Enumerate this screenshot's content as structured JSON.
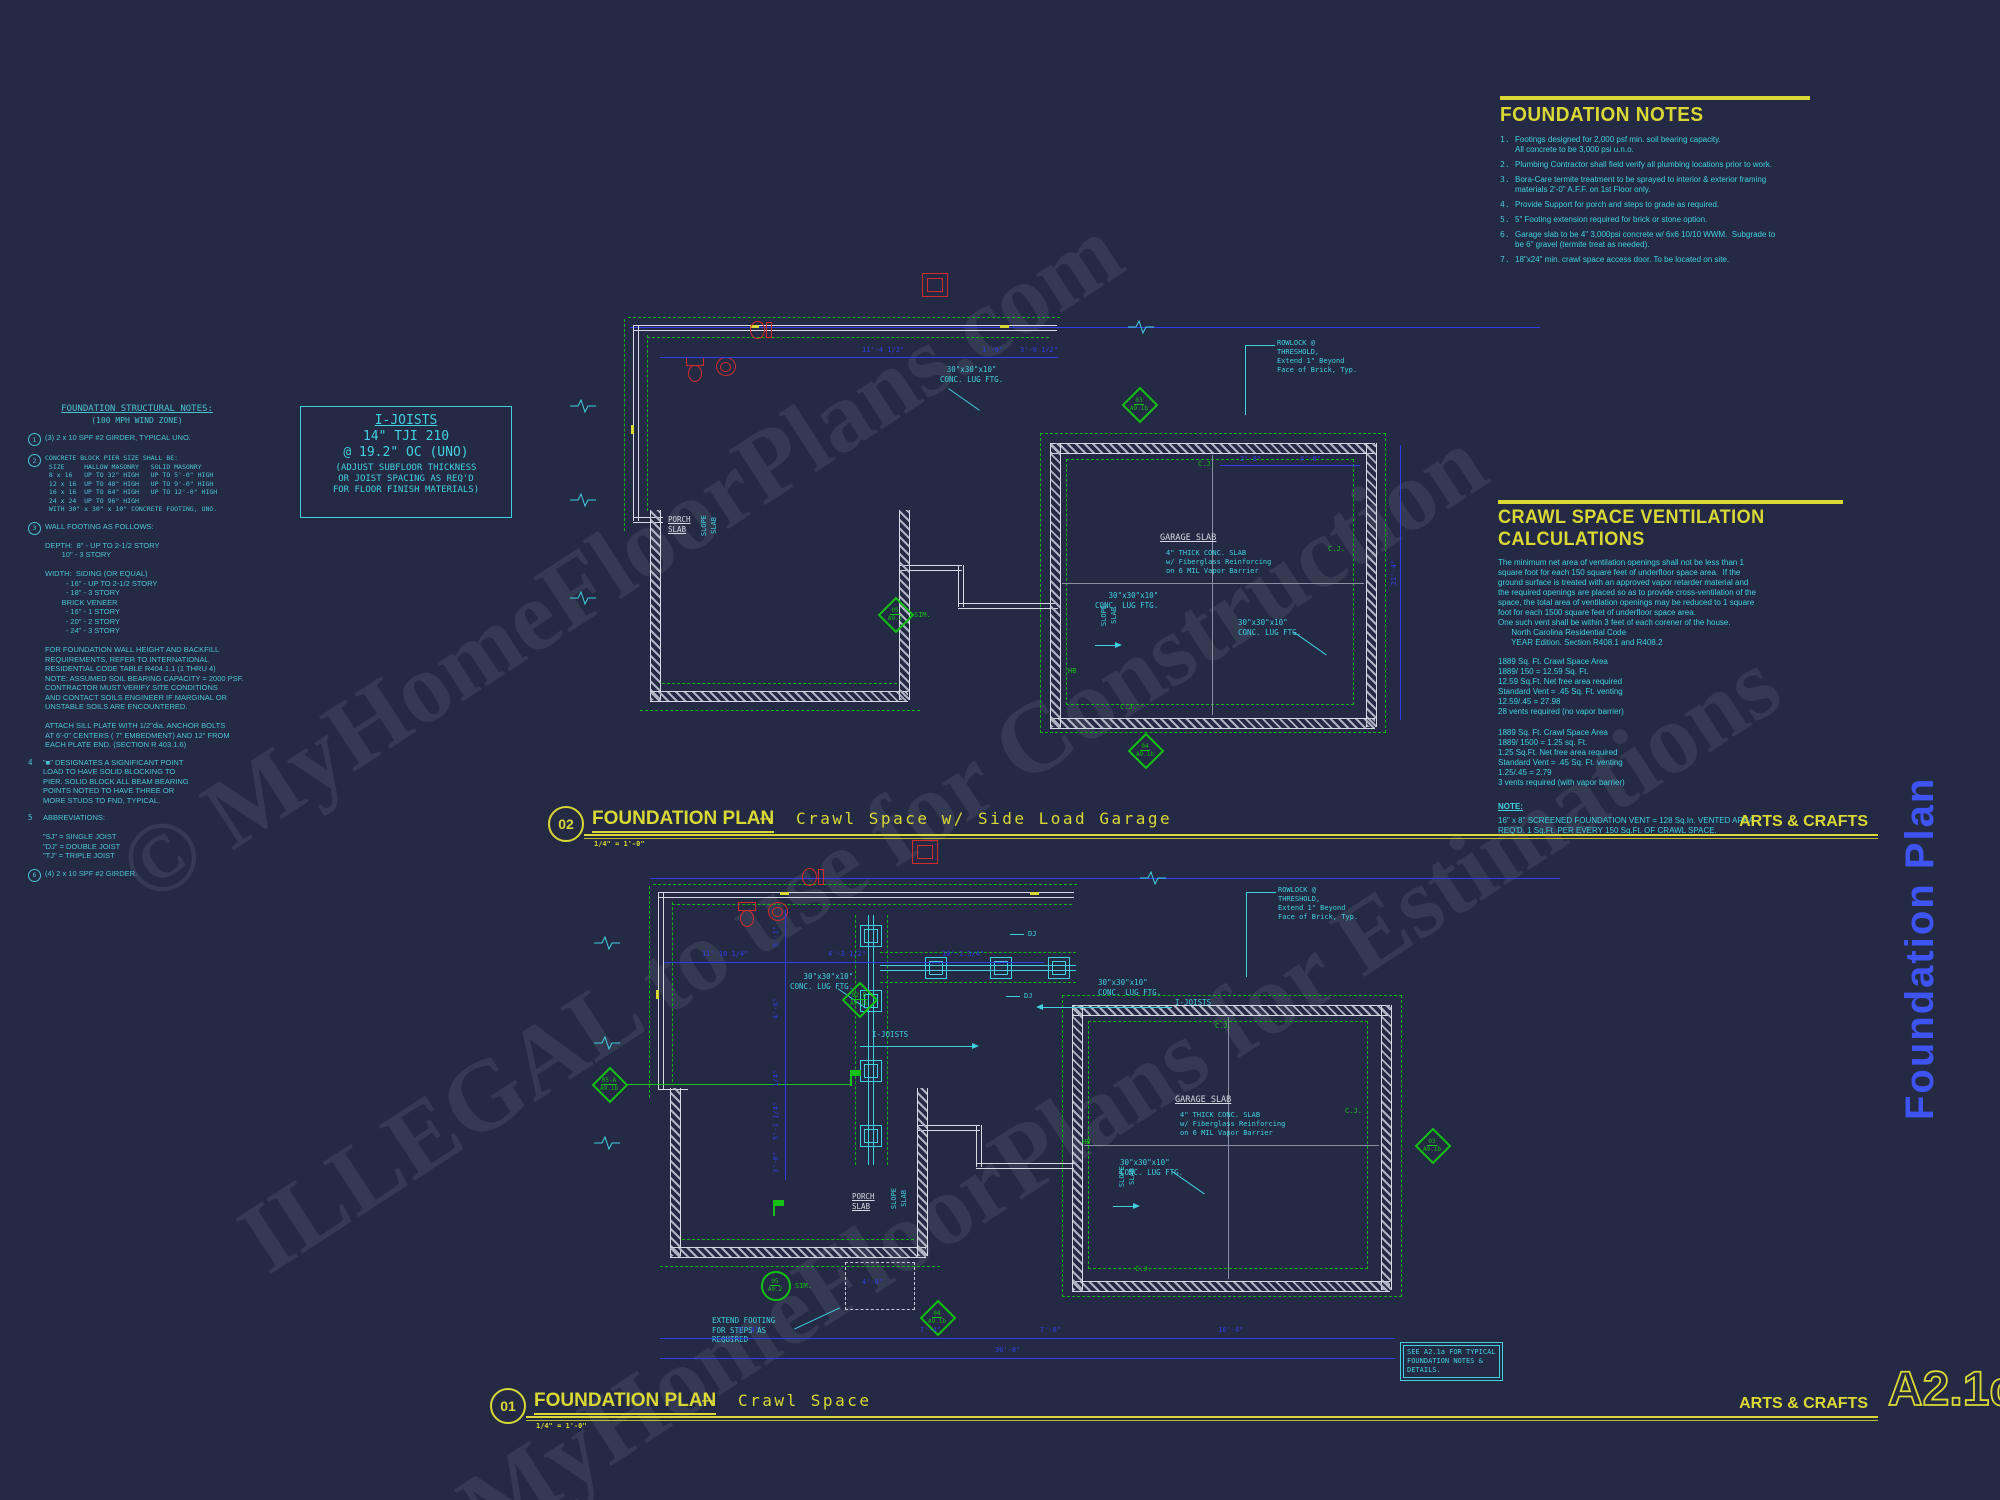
{
  "sheet": {
    "background": "#242a43",
    "number": "A2.1d",
    "side_title": "Foundation Plan",
    "style_label": "ARTS & CRAFTS",
    "see_note": "SEE A2.1a FOR TYPICAL\nFOUNDATION NOTES &\nDETAILS."
  },
  "colors": {
    "cyan_text": "#41d0e0",
    "yellow_accent": "#d9d835",
    "green_lines": "#16c216",
    "dimension_blue": "#2e3ee8",
    "fixture_red": "#d02c2c",
    "wall_gray": "#d6dae4",
    "side_title_blue": "#3d54f2"
  },
  "watermark": {
    "line1": "© MyHomeFloorPlans.com",
    "line2": "ILLEGAL to use for Construction",
    "line3": "MyHomeFloorPlans for Estimations"
  },
  "foundation_notes": {
    "title": "FOUNDATION NOTES",
    "items": [
      {
        "n": "1.",
        "text": "Footings designed for 2,000 psf min. soil bearing capacity.\nAll concrete to be 3,000 psi u.n.o."
      },
      {
        "n": "2.",
        "text": "Plumbing Contractor shall field verify all plumbing locations prior to work."
      },
      {
        "n": "3.",
        "text": "Bora-Care termite treatment to be sprayed to interior & exterior framing\nmaterials 2'-0\" A.F.F. on 1st Floor only."
      },
      {
        "n": "4.",
        "text": "Provide Support for porch and steps to grade as required."
      },
      {
        "n": "5.",
        "text": "5\" Footing extension required for brick or stone option."
      },
      {
        "n": "6.",
        "text": "Garage slab to be 4\" 3,000psi concrete w/ 6x6 10/10 WWM.  Subgrade to\nbe 6\" gravel (termite treat as needed)."
      },
      {
        "n": "7.",
        "text": "18\"x24\" min. crawl space access door. To be located on site."
      }
    ]
  },
  "ventilation": {
    "title": "CRAWL SPACE VENTILATION CALCULATIONS",
    "paragraph": "The minimum net area of ventilation openings shall not be less than 1\nsquare foot for each 150 square feet of underfloor space area.  If the\nground surface is treated with an approved vapor retarder material and\nthe required openings are placed so as to provide cross-ventilation of the\nspace, the total area of ventilation openings may be reduced to 1 square\nfoot for each 1500 square feet of underfloor space area.\nOne such vent shall be within 3 feet of each corener of the house.\n      North Carolina Residential Code\n      YEAR Edition. Section R408.1 and R408.2",
    "calc_no_barrier": "1889 Sq. Ft. Crawl Space Area\n1889/ 150 = 12.59 Sq. Ft.\n12.59 Sq.Ft. Net free area required\nStandard Vent = .45 Sq. Ft. venting\n12.59/.45 = 27.98\n28 vents required (no vapor barrier)",
    "calc_vapor_barrier": "1889 Sq. Ft. Crawl Space Area\n1889/ 1500 = 1.25 sq. Ft.\n1.25 Sq.Ft. Net free area required\nStandard Vent = .45 Sq. Ft. venting\n1.25/.45 = 2.79\n3 vents required (with vapor barrier)",
    "note_title": "NOTE:",
    "note_text": "16\" x 8\" SCREENED FOUNDATION VENT = 128 Sq.In. VENTED AREA\nREQ'D. 1 Sq.Ft. PER EVERY 150 Sq.Ft. OF CRAWL SPACE."
  },
  "structural_notes": {
    "title": "FOUNDATION STRUCTURAL NOTES:",
    "subtitle": "(100 MPH WIND ZONE)",
    "blocks": [
      {
        "num": "1",
        "text": "(3) 2 x 10 SPF #2 GIRDER, TYPICAL UNO."
      },
      {
        "num": "2",
        "text": "CONCRETE BLOCK PIER SIZE SHALL BE:\n SIZE     HALLOW MASONRY   SOLID MASONRY\n 8 x 16   UP TO 32\" HIGH   UP TO 5'-0\" HIGH\n 12 x 16  UP TO 48\" HIGH   UP TO 9'-0\" HIGH\n 16 x 16  UP TO 64\" HIGH   UP TO 12'-0\" HIGH\n 24 x 24  UP TO 96\" HIGH\n WITH 30\" x 30\" x 10\" CONCRETE FOOTING, UNO."
      },
      {
        "num": "3",
        "text": "WALL FOOTING AS FOLLOWS:\n\nDEPTH:  8\" - UP TO 2-1/2 STORY\n        10\" - 3 STORY\n\nWIDTH:  SIDING (OR EQUAL)\n          - 16\" - UP TO 2-1/2 STORY\n          - 18\" - 3 STORY\n        BRICK VENEER\n          - 16\" - 1 STORY\n          - 20\" - 2 STORY\n          - 24\" - 3 STORY\n\nFOR FOUNDATION WALL HEIGHT AND BACKFILL\nREQUIREMENTS, REFER TO INTERNATIONAL\nRESIDENTIAL CODE TABLE R404.1.1 (1 THRU 4)\nNOTE: ASSUMED SOIL BEARING CAPACITY = 2000 PSF.\nCONTRACTOR MUST VERIFY SITE CONDITIONS\nAND CONTACT SOILS ENGINEER IF MARGINAL OR\nUNSTABLE SOILS ARE ENCOUNTERED.\n\nATTACH SILL PLATE WITH 1/2\"dia. ANCHOR BOLTS\nAT 6'-0\" CENTERS ( 7\" EMBEDMENT) AND 12\" FROM\nEACH PLATE END. (SECTION R 403.1.6)"
      },
      {
        "num": "4",
        "text": "\"■\" DESIGNATES A SIGNIFICANT POINT\nLOAD TO HAVE SOLID BLOCKING TO\nPIER. SOLID BLOCK ALL BEAM BEARING\nPOINTS NOTED TO HAVE THREE OR\nMORE STUDS TO FND, TYPICAL."
      },
      {
        "num": "5",
        "text": "ABBREVIATIONS:\n\n\"SJ\" = SINGLE JOIST\n\"DJ\" = DOUBLE JOIST\n\"TJ\" = TRIPLE JOIST"
      },
      {
        "num": "6",
        "text": "(4) 2 x 10 SPF #2 GIRDER."
      }
    ]
  },
  "ijoists_box": {
    "line1": "I-JOISTS",
    "line2": "14\" TJI 210",
    "line3": "@ 19.2\" OC (UNO)",
    "line4": "(ADJUST SUBFLOOR THICKNESS\nOR JOIST SPACING AS REQ'D\nFOR FLOOR FINISH MATERIALS)"
  },
  "plan_labels": {
    "garage_slab": "GARAGE SLAB",
    "garage_slab_spec": "4\" THICK CONC. SLAB\nw/ Fiberglass Reinforcing\non 6 MIL Vapor Barrier",
    "lug_footing": "30\"x30\"x10\"\nCONC. LUG FTG.",
    "porch_slab": "PORCH\nSLAB",
    "slope": "SLOPE",
    "slab": "SLAB",
    "rowlock": "ROWLOCK @\nTHRESHOLD,\nExtend 1\" Beyond\nFace of Brick, Typ.",
    "ijoists": "I-JOISTS",
    "cj": "C.J.",
    "dj": "DJ",
    "hb": "HB",
    "sim": "SIM.",
    "extend_footing": "EXTEND FOOTING\nFOR STEPS AS\nREQUIRED"
  },
  "plans": [
    {
      "number": "02",
      "title": "FOUNDATION PLAN",
      "dash": "—",
      "subtitle": "Crawl Space w/ Side Load Garage",
      "scale": "1/4\" = 1'-0\"",
      "dims": {
        "top1": "11'-4 1/2\"",
        "top2": "1'-6\"",
        "top3": "3'-0 1/2\"",
        "g1": "2'-8\"",
        "g2": "4'-8\"",
        "right": "21'-4\""
      },
      "markers": {
        "m1": {
          "id": "03",
          "sheet": "A9.1b"
        },
        "m2": {
          "id": "04",
          "sheet": "A9.1b"
        },
        "m3": {
          "id": "05",
          "sheet": "A9.2"
        }
      }
    },
    {
      "number": "01",
      "title": "FOUNDATION PLAN",
      "dash": "—",
      "subtitle": "Crawl Space",
      "scale": "1/4\" = 1'-0\"",
      "dims": {
        "top1": "11'-10 1/4\"",
        "top2": "4'-3 1/2\"",
        "top3": "10'-1 3/4\"",
        "v1": "5'-1\"",
        "v2": "4'-6\"",
        "v3": "1/4\"",
        "v4": "5'-1 1/4\"",
        "v5": "3'-0\"",
        "stair": "4'-0\"",
        "b1": "5'-4\"",
        "b2": "7'-4\"",
        "b3": "7'-8\"",
        "b4": "16'-4\"",
        "total": "36'-8\""
      },
      "markers": {
        "m1": {
          "id": "02-B",
          "sheet": "A9.1b"
        },
        "m2": {
          "id": "05-A",
          "sheet": "A9.1b"
        },
        "m3": {
          "id": "03",
          "sheet": "A9.1b"
        },
        "m4": {
          "id": "04",
          "sheet": "A9.1b"
        },
        "m5": {
          "id": "05",
          "sheet": "A9.2"
        }
      }
    }
  ]
}
